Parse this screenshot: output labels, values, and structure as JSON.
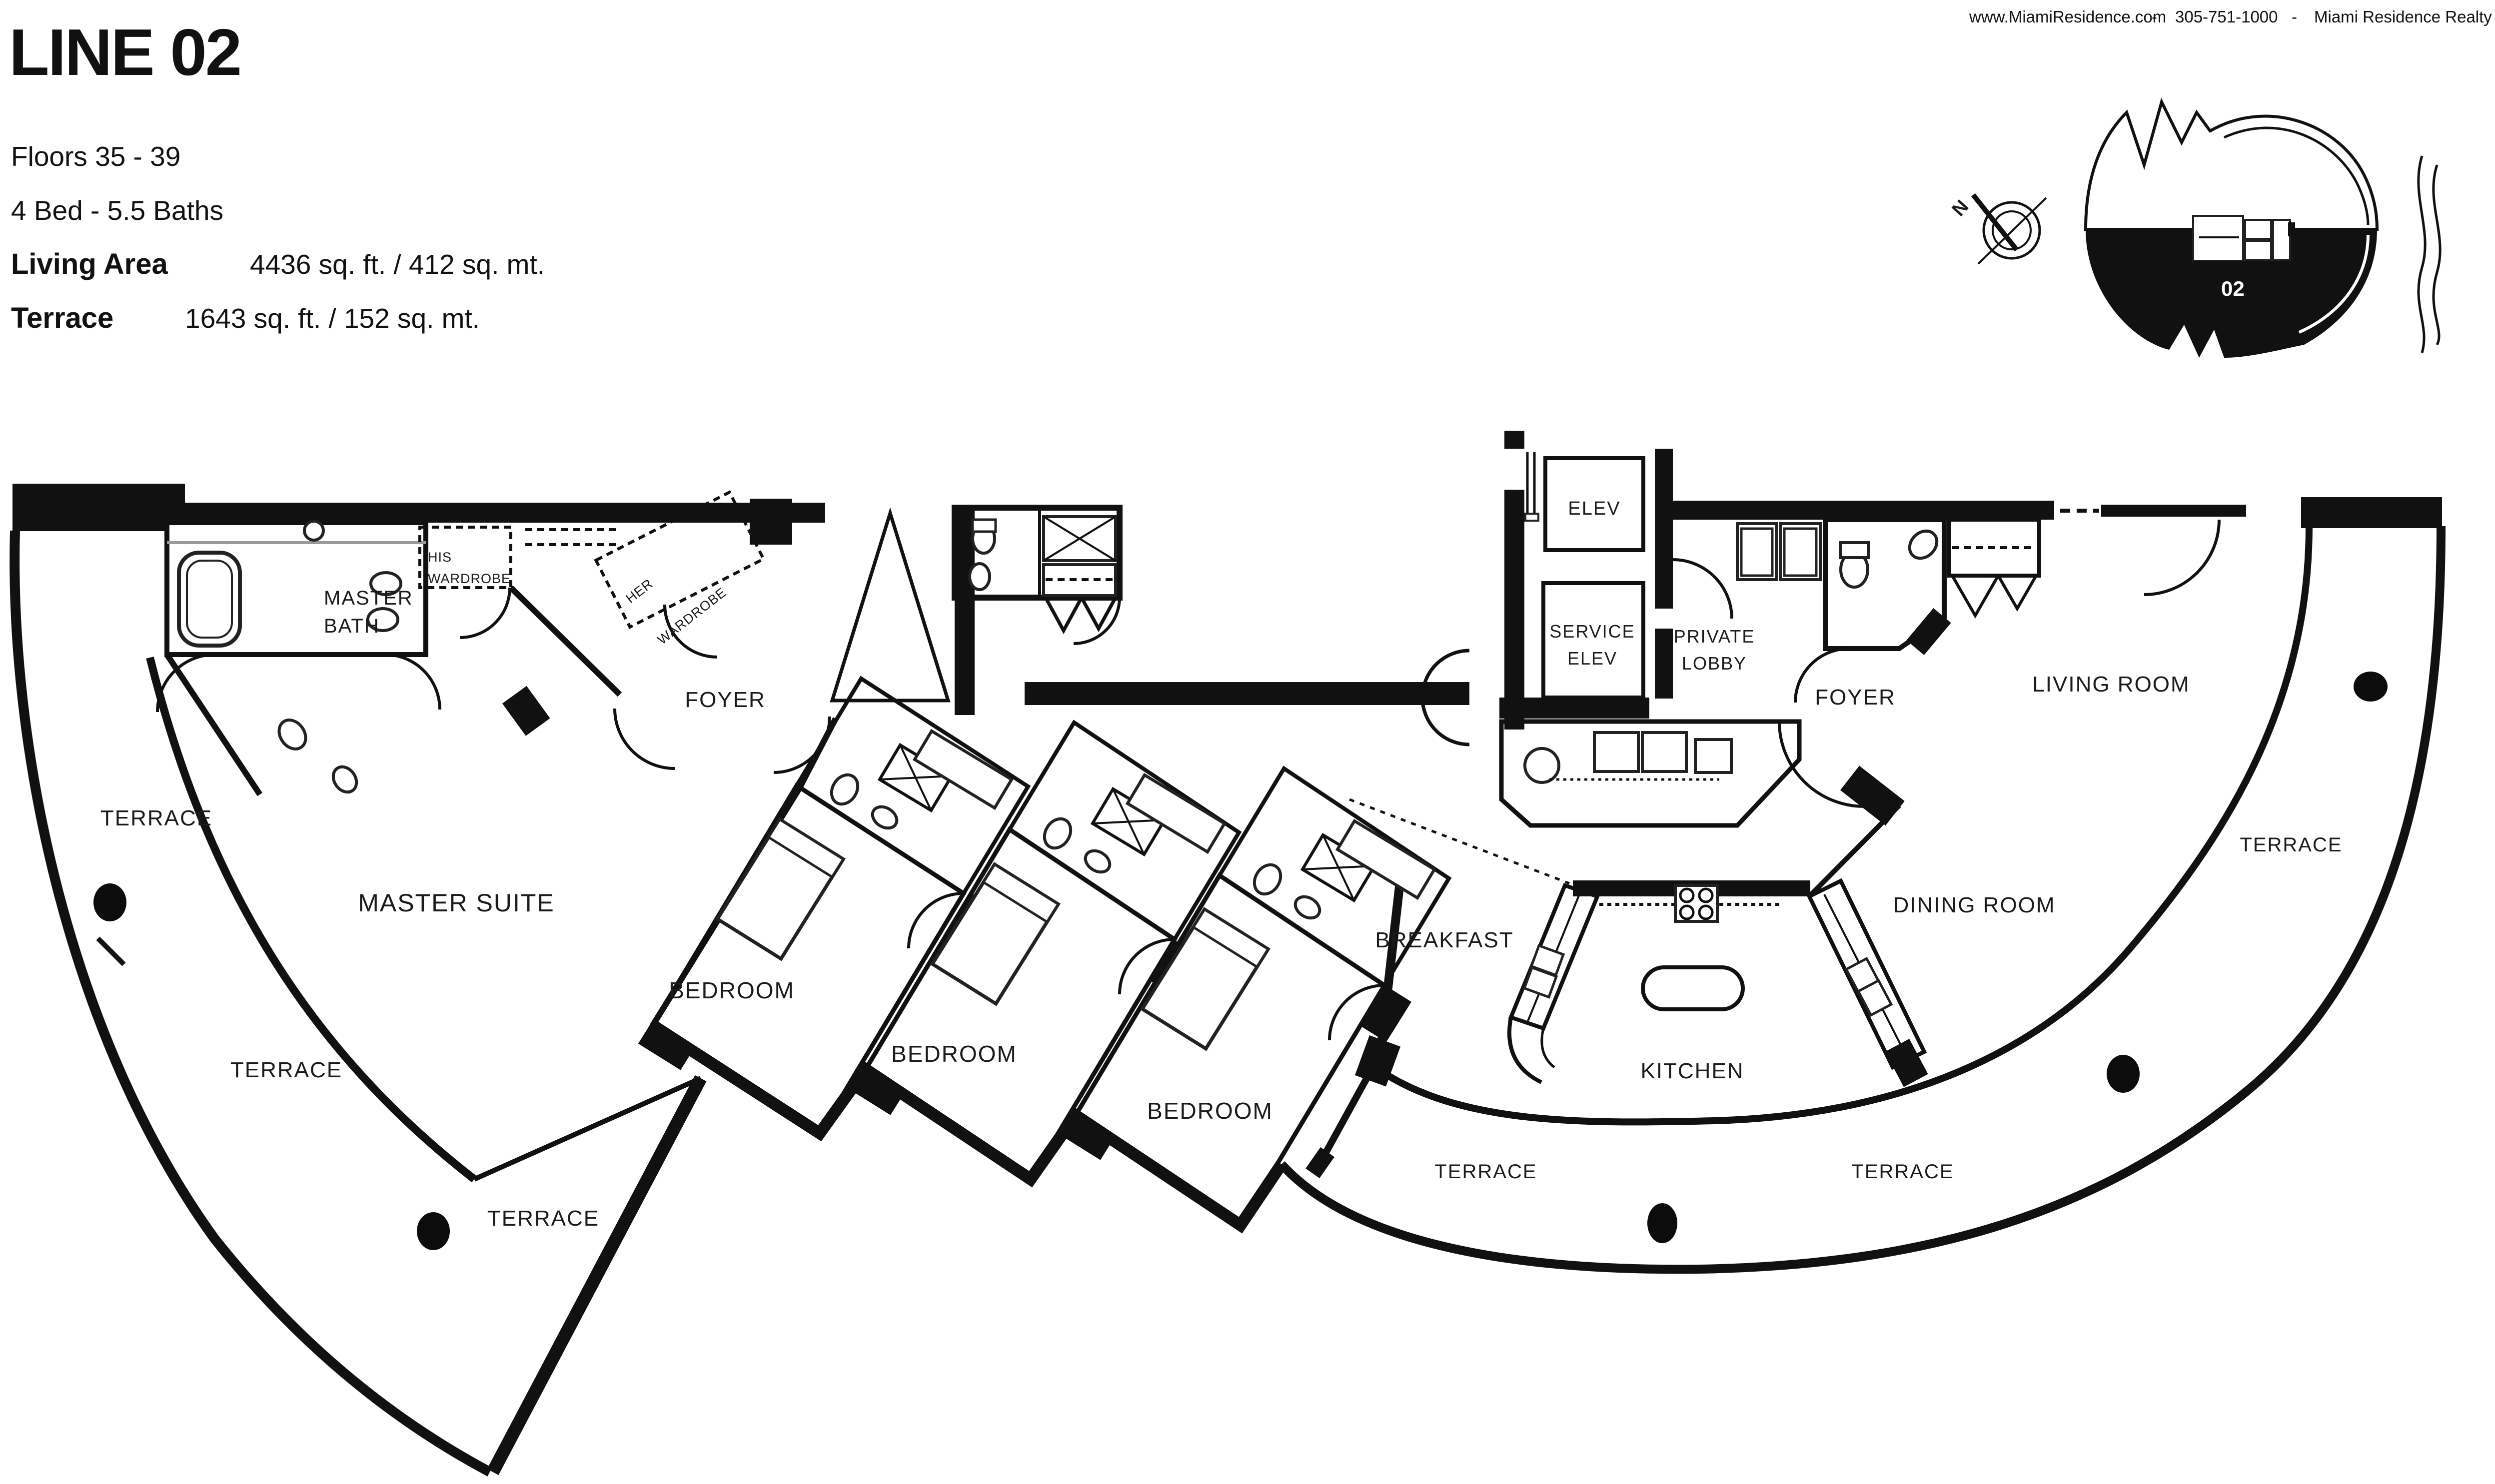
{
  "topbar": {
    "website": "www.MiamiResidence.com",
    "dash1": "-",
    "phone": "305-751-1000",
    "dash2": "-",
    "company": "Miami Residence Realty"
  },
  "header": {
    "title": "LINE 02",
    "floors": "Floors 35 - 39",
    "beds": "4 Bed - 5.5 Baths",
    "living_area_label": "Living Area",
    "living_area_value": "4436 sq. ft. / 412 sq. mt.",
    "terrace_label": "Terrace",
    "terrace_value": "1643 sq. ft. / 152 sq. mt."
  },
  "keyplan": {
    "unit_number": "02",
    "compass_north": "N"
  },
  "rooms": {
    "master_bath": [
      "MASTER",
      "BATH"
    ],
    "his_wardrobe": [
      "HIS",
      "WARDROBE"
    ],
    "her_wardrobe": [
      "HER",
      "WARDROBE"
    ],
    "foyer_left": "FOYER",
    "master_suite": "MASTER SUITE",
    "bedroom_1": "BEDROOM",
    "bedroom_2": "BEDROOM",
    "bedroom_3": "BEDROOM",
    "breakfast": "BREAKFAST",
    "kitchen": "KITCHEN",
    "dining_room": "DINING ROOM",
    "living_room": "LIVING ROOM",
    "foyer_right": "FOYER",
    "elev": "ELEV",
    "service_elev": [
      "SERVICE",
      "ELEV"
    ],
    "private_lobby": [
      "PRIVATE",
      "LOBBY"
    ],
    "terrace_upper_left": "TERRACE",
    "terrace_mid_left": "TERRACE",
    "terrace_lower_left": "TERRACE",
    "terrace_bottom_left": "TERRACE",
    "terrace_bottom_right": "TERRACE",
    "terrace_right": "TERRACE"
  }
}
